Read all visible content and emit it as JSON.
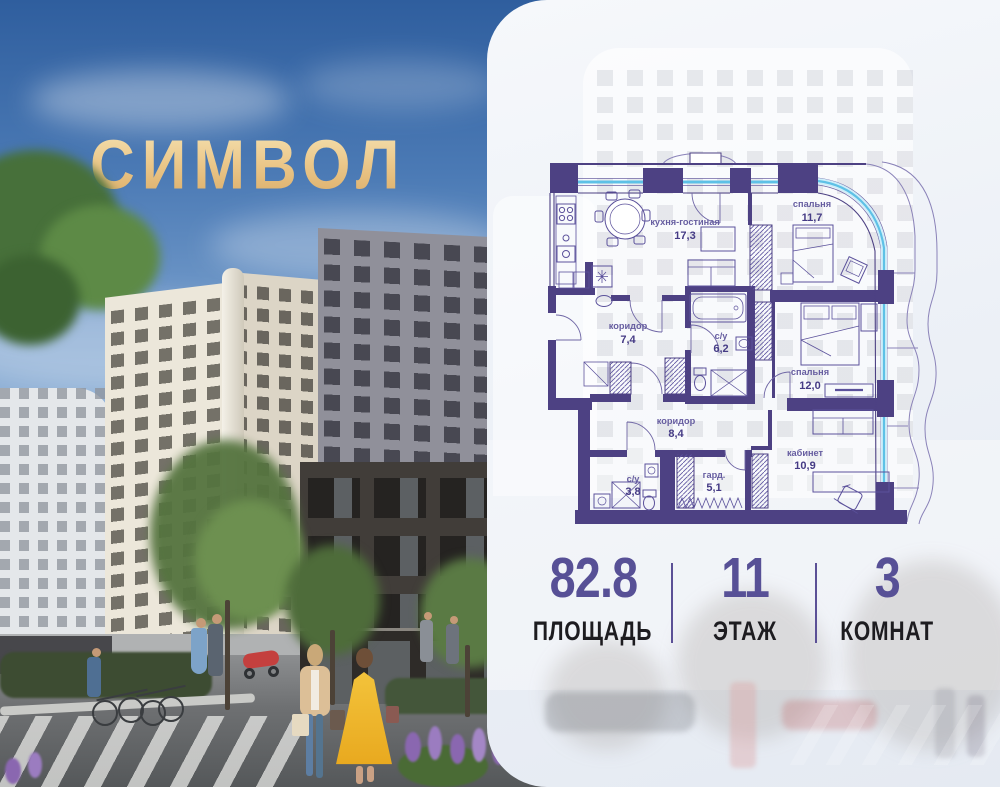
{
  "logo": {
    "text": "СИМВОЛ"
  },
  "floorplan": {
    "rooms": [
      {
        "name": "кухня-гостиная",
        "area": "17,3"
      },
      {
        "name": "спальня",
        "area": "11,7"
      },
      {
        "name": "коридор",
        "area": "7,4"
      },
      {
        "name": "с/у",
        "area": "6,2"
      },
      {
        "name": "спальня",
        "area": "12,0"
      },
      {
        "name": "коридор",
        "area": "8,4"
      },
      {
        "name": "с/у",
        "area": "3,8"
      },
      {
        "name": "гард.",
        "area": "5,1"
      },
      {
        "name": "кабинет",
        "area": "10,9"
      }
    ]
  },
  "stats": [
    {
      "value": "82.8",
      "label": "ПЛОЩАДЬ"
    },
    {
      "value": "11",
      "label": "ЭТАЖ"
    },
    {
      "value": "3",
      "label": "КОМНАТ"
    }
  ],
  "colors": {
    "wall_purple": "#4d4183",
    "glazing_blue": "#5ec1e6",
    "logo_gold": "#e2b775",
    "stat_number": "#575096",
    "stat_label": "#1d1c20"
  }
}
